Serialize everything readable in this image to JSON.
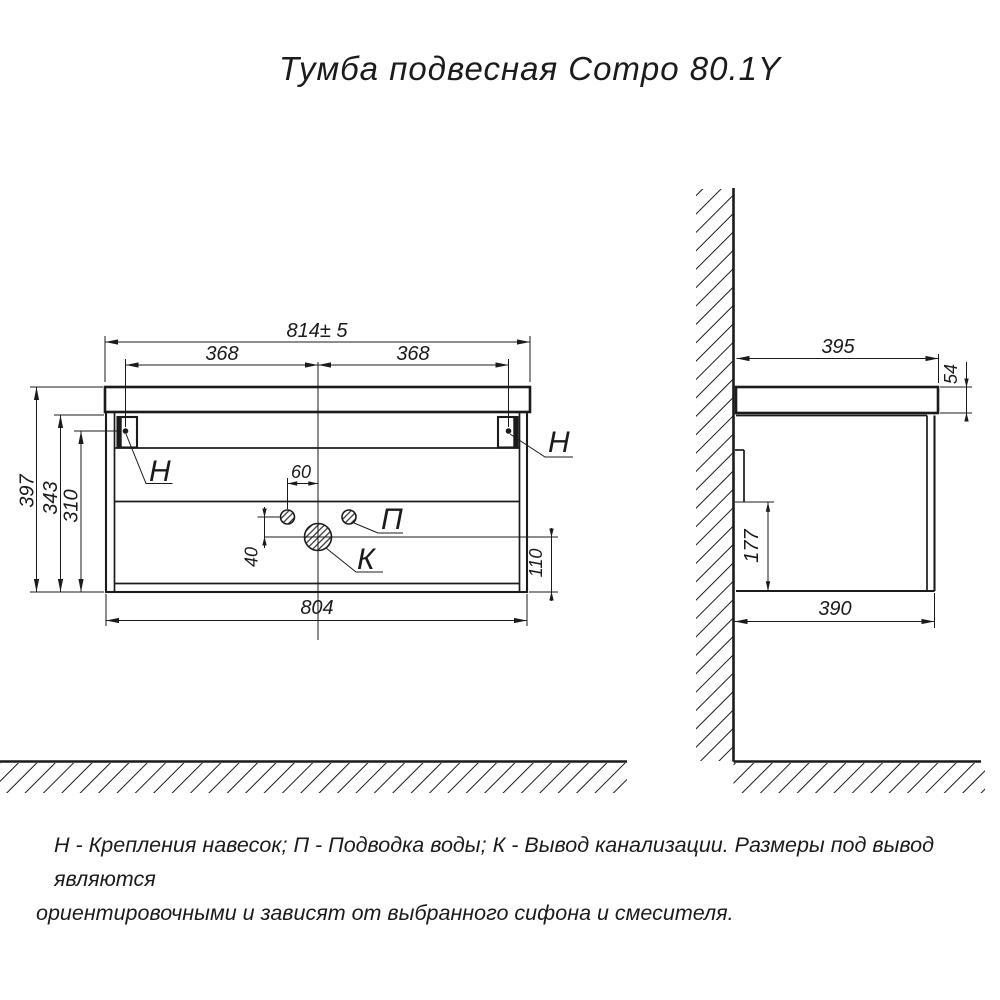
{
  "title": "Тумба подвесная Compo 80.1Y",
  "front_view": {
    "dims": {
      "width_top": "814± 5",
      "bracket_left_offset": "368",
      "bracket_right_offset": "368",
      "height_total": "397",
      "height_body": "343",
      "height_bracket": "310",
      "water_offset": "60",
      "drain_offset": "40",
      "drain_height": "110",
      "width_body": "804"
    },
    "labels": {
      "bracket_left": "H",
      "bracket_right": "H",
      "water": "П",
      "drain": "К"
    }
  },
  "side_view": {
    "dims": {
      "depth_top": "395",
      "top_thickness": "54",
      "recess_height": "177",
      "depth_body": "390"
    }
  },
  "footnote": {
    "line1": "Н - Крепления навесок; П - Подводка воды; К - Вывод канализации. Размеры под вывод являются",
    "line2": "ориентировочными и зависят от выбранного сифона и смесителя."
  }
}
